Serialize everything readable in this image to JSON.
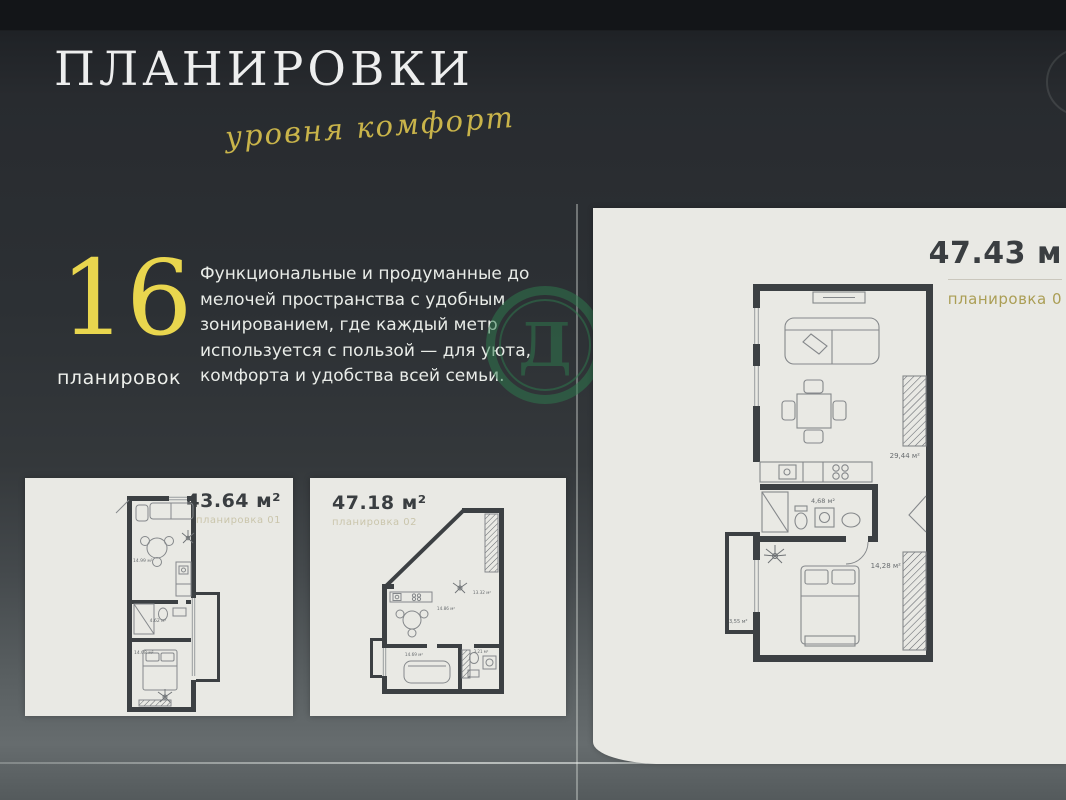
{
  "header": {
    "title": "ПЛАНИРОВКИ",
    "tagline": "уровня комфорт"
  },
  "intro": {
    "count": "16",
    "count_label": "планировок",
    "description": "Функциональные и продуманные до мелочей пространства с удобным зонированием, где каждый метр используется с пользой — для уюта, комфорта и удобства всей семьи."
  },
  "watermark": {
    "letter": "Д",
    "color": "#2e7c4e"
  },
  "plans": [
    {
      "area": "43.64 м²",
      "variant": "планировка 01",
      "rooms": [
        "14.99 м²",
        "4.62 м²",
        "14.08 м²"
      ]
    },
    {
      "area": "47.18 м²",
      "variant": "планировка 02",
      "rooms": [
        "13.32 м²",
        "14.86 м²",
        "14.69 м²",
        "3.21 м²"
      ]
    },
    {
      "area": "47.43 м",
      "variant": "планировка 0",
      "rooms": [
        "29,44 м²",
        "4,68 м²",
        "14,28 м²",
        "3,55 м²"
      ]
    }
  ],
  "colors": {
    "accent_gold": "#e9d64e",
    "script_gold": "#c9b44a",
    "variant_gold": "#ab9e55",
    "watermark_green": "#2e7c4e",
    "card_background": "#e9e9e4",
    "wall_dark": "#3c4043"
  }
}
